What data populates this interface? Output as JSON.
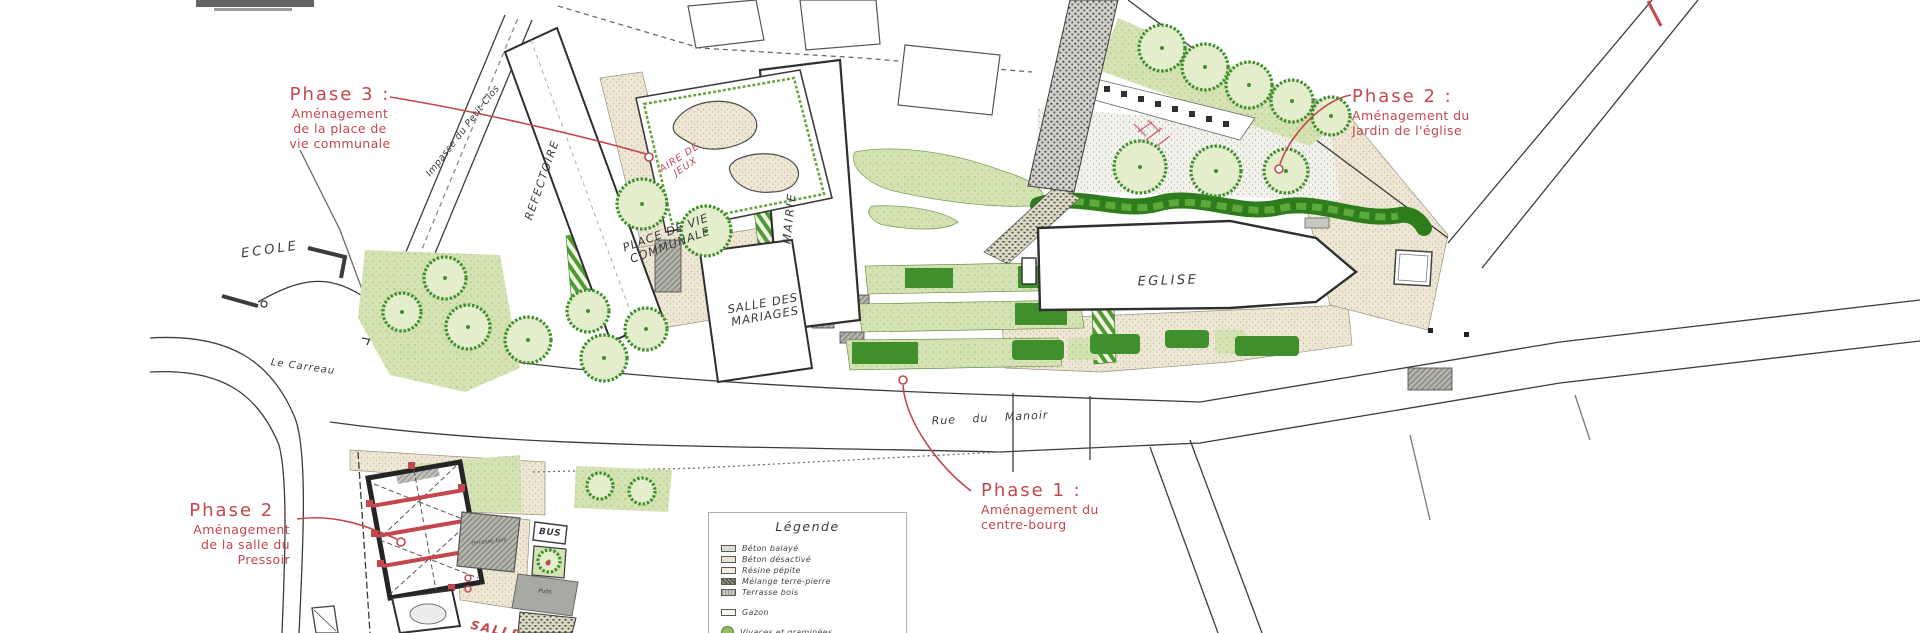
{
  "colors": {
    "annotation_red": "#c2484e",
    "linework_gray": "#3c3c3c",
    "tree_green": "#3f8f2c",
    "groundcover_green": "#d5e2b4",
    "gravel_beige": "#eee7d6",
    "hatch_gray": "#b7b6ae"
  },
  "labels": {
    "ecole": "ECOLE",
    "refectoire": "REFECTOIRE",
    "mairie": "MAIRIE",
    "salle_des_mariages": "SALLE DES MARIAGES",
    "aire_de_jeux": "AIRE DE JEUX",
    "place_de_vie_communale": "PLACE DE VIE COMMUNALE",
    "eglise": "EGLISE",
    "le_carreau": "Le Carreau",
    "rue_du_manoir": "Rue du Manoir",
    "impasse_du_petit_clos": "Impasse du Petit Clos",
    "bus": "BUS",
    "terrasse_bois": "terrasse bois",
    "puits": "Puits",
    "salle_pressoir_partial": "SALLE"
  },
  "annotations": {
    "phase3": {
      "title": "Phase 3 :",
      "lines": [
        "Aménagement",
        "de la place de",
        "vie communale"
      ]
    },
    "phase2_eglise": {
      "title": "Phase 2 :",
      "lines": [
        "Aménagement du",
        "Jardin de l'église"
      ]
    },
    "phase1": {
      "title": "Phase 1 :",
      "lines": [
        "Aménagement du",
        "centre-bourg"
      ]
    },
    "phase2_pressoir": {
      "title": "Phase 2 :",
      "lines": [
        "Aménagement",
        "de la salle du",
        "Pressoir"
      ]
    }
  },
  "legend": {
    "title": "Légende",
    "items": [
      {
        "label": "Béton balayé",
        "swatch": "beton-balaye"
      },
      {
        "label": "Béton désactivé",
        "swatch": "beton-desactive"
      },
      {
        "label": "Résine pépite",
        "swatch": "resine-pepite"
      },
      {
        "label": "Mélange terre-pierre",
        "swatch": "melange-terre-pierre"
      },
      {
        "label": "Terrasse bois",
        "swatch": "terrasse-bois"
      },
      {
        "label": "Gazon",
        "swatch": "gazon"
      },
      {
        "label": "Vivaces et graminées",
        "swatch": "vivaces-graminees"
      }
    ]
  }
}
